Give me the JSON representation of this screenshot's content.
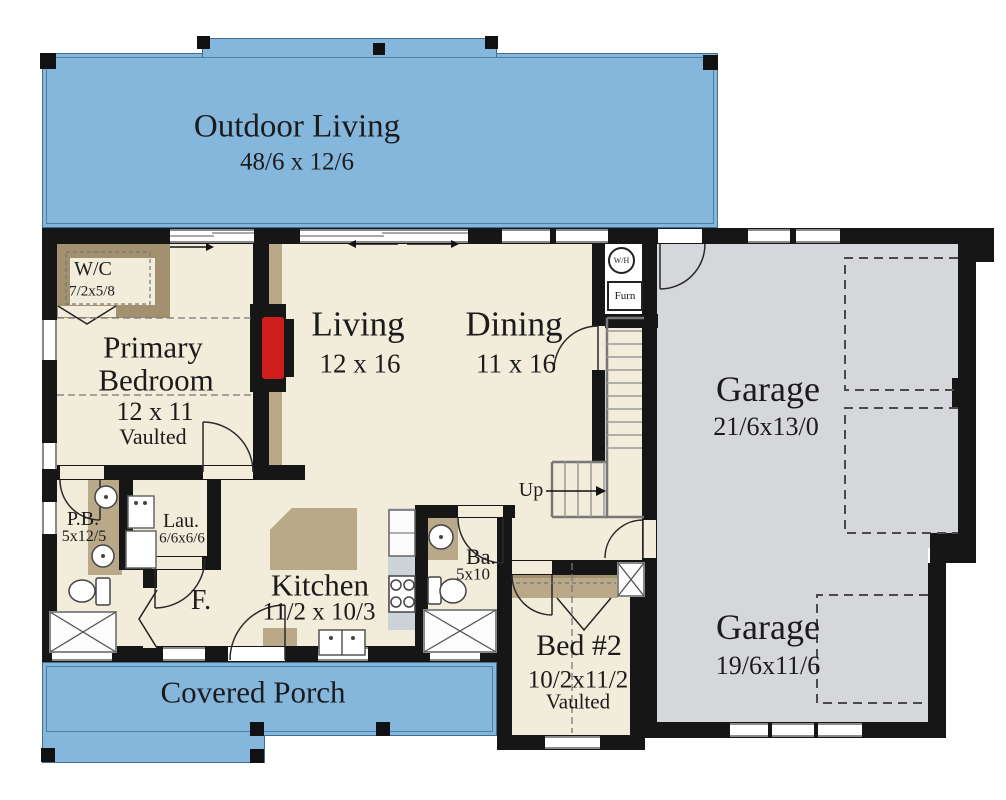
{
  "rooms": {
    "outdoor_living": {
      "name": "Outdoor Living",
      "dims": "48/6 x 12/6"
    },
    "covered_porch": {
      "name": "Covered Porch"
    },
    "primary_bedroom": {
      "name_line1": "Primary",
      "name_line2": "Bedroom",
      "dims": "12 x 11",
      "note": "Vaulted"
    },
    "wc": {
      "name": "W/C",
      "dims": "7/2x5/8"
    },
    "living": {
      "name": "Living",
      "dims": "12 x 16"
    },
    "dining": {
      "name": "Dining",
      "dims": "11 x 16"
    },
    "garage_upper": {
      "name": "Garage",
      "dims": "21/6x13/0"
    },
    "garage_lower": {
      "name": "Garage",
      "dims": "19/6x11/6"
    },
    "primary_bath": {
      "name": "P.B.",
      "dims": "5x12/5"
    },
    "laundry": {
      "name": "Lau.",
      "dims": "6/6x6/6"
    },
    "kitchen": {
      "name": "Kitchen",
      "dims": "11/2 x 10/3"
    },
    "bath2": {
      "name": "Ba.",
      "dims": "5x10"
    },
    "bed2": {
      "name": "Bed #2",
      "dims": "10/2x11/2",
      "note": "Vaulted"
    },
    "foyer": {
      "name": "F."
    }
  },
  "stairs": {
    "direction_label": "Up"
  },
  "utility": {
    "water_heater_label": "W/H",
    "furnace_label": "Furn"
  },
  "colors": {
    "porch_blue": "#85b7dc",
    "floor_cream": "#f2ecdb",
    "garage_gray": "#d6d7da",
    "wall_black": "#161616",
    "cabinet_tan": "#b9a988",
    "fireplace_red": "#cf1d1c"
  }
}
